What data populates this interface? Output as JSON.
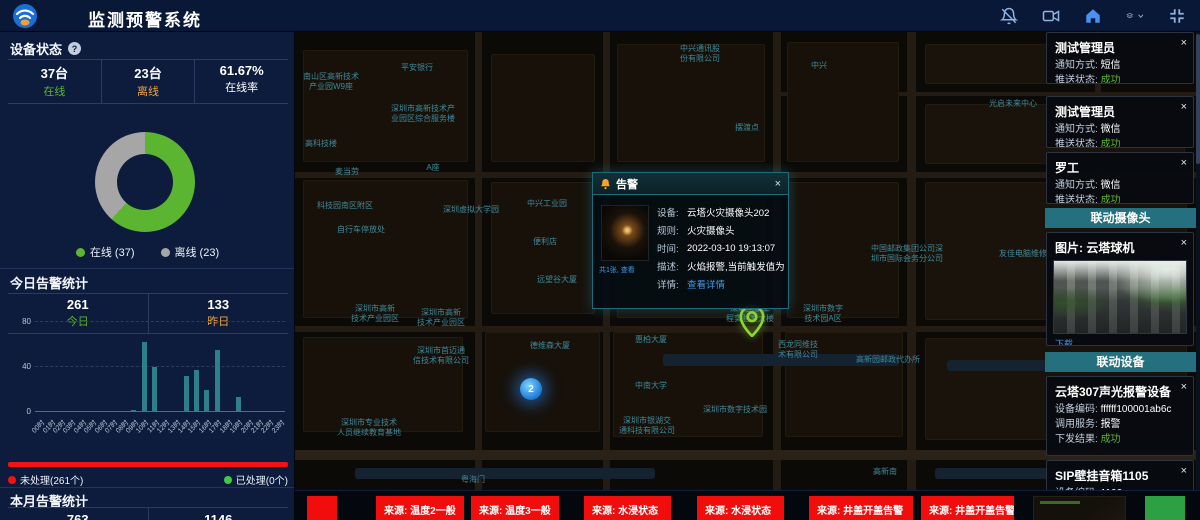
{
  "header": {
    "title": "监测预警系统",
    "icons": [
      "notification-bell-off",
      "video-camera",
      "home",
      "layer-switcher",
      "fullscreen-toggle"
    ]
  },
  "device_status": {
    "title": "设备状态",
    "help": "?",
    "stats": [
      {
        "value": "37台",
        "label": "在线"
      },
      {
        "value": "23台",
        "label": "离线"
      },
      {
        "value": "61.67%",
        "label": "在线率"
      }
    ],
    "legend": [
      {
        "label": "在线 (37)",
        "color": "#5cb531"
      },
      {
        "label": "离线 (23)",
        "color": "#a6a6a6"
      }
    ]
  },
  "today_alarms": {
    "title": "今日告警统计",
    "stats": [
      {
        "value": "261",
        "label": "今日"
      },
      {
        "value": "133",
        "label": "昨日"
      }
    ],
    "unprocessed": "未处理(261个)",
    "processed": "已处理(0个)"
  },
  "month_alarms": {
    "title": "本月告警统计",
    "values": [
      "763",
      "1146"
    ]
  },
  "chart_data": [
    {
      "id": "device-status-donut",
      "type": "pie",
      "labels": [
        "在线",
        "离线"
      ],
      "values": [
        37,
        23
      ],
      "colors": [
        "#5cb531",
        "#a6a6a6"
      ],
      "donut": true,
      "center_text": "",
      "legend_position": "bottom"
    },
    {
      "id": "today-alarms-by-hour",
      "type": "bar",
      "categories": [
        "00时",
        "01时",
        "02时",
        "03时",
        "04时",
        "05时",
        "06时",
        "07时",
        "08时",
        "09时",
        "10时",
        "11时",
        "12时",
        "13时",
        "14时",
        "15时",
        "16时",
        "17时",
        "18时",
        "19时",
        "20时",
        "21时",
        "22时",
        "23时"
      ],
      "values": [
        0,
        0,
        0,
        0,
        0,
        0,
        0,
        0,
        0,
        2,
        62,
        40,
        0,
        0,
        32,
        37,
        20,
        55,
        0,
        13,
        0,
        0,
        0,
        0
      ],
      "ylim": [
        0,
        80
      ],
      "yticks": [
        0,
        40,
        80
      ],
      "bar_color": "#2e7f8c",
      "grid": "dashed",
      "xlabel": "",
      "ylabel": ""
    }
  ],
  "map": {
    "labels": [
      {
        "text": "中兴通讯股\n份有限公司",
        "x": 405,
        "y": 22
      },
      {
        "text": "平安银行",
        "x": 122,
        "y": 36
      },
      {
        "text": "南山区高新技术\n产业园W9座",
        "x": 36,
        "y": 50
      },
      {
        "text": "深圳市高新技术产\n业园区综合服务楼",
        "x": 128,
        "y": 82
      },
      {
        "text": "高科技楼",
        "x": 26,
        "y": 112
      },
      {
        "text": "中兴",
        "x": 524,
        "y": 34
      },
      {
        "text": "光启未来中心",
        "x": 718,
        "y": 72
      },
      {
        "text": "麦当劳",
        "x": 52,
        "y": 140
      },
      {
        "text": "A座",
        "x": 138,
        "y": 136
      },
      {
        "text": "科技园南区附区",
        "x": 50,
        "y": 174
      },
      {
        "text": "深圳虚拟大学园",
        "x": 176,
        "y": 178
      },
      {
        "text": "中兴工业园",
        "x": 252,
        "y": 172
      },
      {
        "text": "便利店",
        "x": 250,
        "y": 210
      },
      {
        "text": "自行车停放处",
        "x": 66,
        "y": 198
      },
      {
        "text": "摆渡点",
        "x": 452,
        "y": 96
      },
      {
        "text": "中国邮政集团公司深\n圳市国际会务分公司",
        "x": 612,
        "y": 222
      },
      {
        "text": "友佳电脑维修",
        "x": 728,
        "y": 222
      },
      {
        "text": "远望谷大厦",
        "x": 262,
        "y": 248
      },
      {
        "text": "德维森大厦",
        "x": 255,
        "y": 314
      },
      {
        "text": "惠柏大厦",
        "x": 356,
        "y": 308
      },
      {
        "text": "深圳市高新\n技术产业园区",
        "x": 80,
        "y": 282
      },
      {
        "text": "深圳市高新\n技术产业园区",
        "x": 146,
        "y": 286
      },
      {
        "text": "深圳市首迈通\n信技术有限公司",
        "x": 146,
        "y": 324
      },
      {
        "text": "深圳市专业技术\n人员继续教育基地",
        "x": 74,
        "y": 396
      },
      {
        "text": "中南大学",
        "x": 356,
        "y": 354
      },
      {
        "text": "深圳市银湖交\n通科技有限公司",
        "x": 352,
        "y": 394
      },
      {
        "text": "深圳国家工\n程实验室大楼",
        "x": 455,
        "y": 282
      },
      {
        "text": "深圳市数字\n技术园A区",
        "x": 528,
        "y": 282
      },
      {
        "text": "西龙同维技\n术有限公司",
        "x": 503,
        "y": 318
      },
      {
        "text": "高新园邮政代办所",
        "x": 593,
        "y": 328
      },
      {
        "text": "深圳市数字技术园",
        "x": 440,
        "y": 378
      },
      {
        "text": "高新南",
        "x": 590,
        "y": 440
      },
      {
        "text": "粤海门",
        "x": 178,
        "y": 448
      }
    ],
    "markers": [
      {
        "type": "cluster",
        "value": "2",
        "x": 236,
        "y": 357
      },
      {
        "type": "pin",
        "x": 457,
        "y": 303
      }
    ]
  },
  "popup": {
    "title": "告警",
    "close": "×",
    "photo_caption": "共1张, 查看",
    "rows": [
      {
        "label": "设备:",
        "value": "云塔火灾摄像头202"
      },
      {
        "label": "规则:",
        "value": "火灾摄像头"
      },
      {
        "label": "时间:",
        "value": "2022-03-10 19:13:07"
      },
      {
        "label": "描述:",
        "value": "火焰报警,当前触发值为..."
      },
      {
        "label": "详情:",
        "value": "查看详情"
      }
    ]
  },
  "notifications": [
    {
      "name": "测试管理员",
      "method_label": "通知方式:",
      "method": "短信",
      "status_label": "推送状态:",
      "status": "成功",
      "close": "×"
    },
    {
      "name": "测试管理员",
      "method_label": "通知方式:",
      "method": "微信",
      "status_label": "推送状态:",
      "status": "成功",
      "close": "×"
    },
    {
      "name": "罗工",
      "method_label": "通知方式:",
      "method": "微信",
      "status_label": "推送状态:",
      "status": "成功",
      "close": "×"
    }
  ],
  "camera_section": {
    "title": "联动摄像头",
    "card_title": "图片: 云塔球机",
    "download_label": "下载",
    "close": "×"
  },
  "device_section": {
    "title": "联动设备",
    "cards": [
      {
        "name": "云塔307声光报警设备",
        "close": "×",
        "rows": [
          {
            "label": "设备编码:",
            "value": "ffffff100001ab6c"
          },
          {
            "label": "调用服务:",
            "value": "报警"
          },
          {
            "label": "下发结果:",
            "value": "成功"
          }
        ]
      },
      {
        "name": "SIP壁挂音箱1105",
        "close": "×",
        "rows": [
          {
            "label": "设备编码:",
            "value": "1106"
          }
        ]
      }
    ]
  },
  "bottom_alerts": [
    "来源: 温度2一般",
    "来源: 温度3一般",
    "来源: 水浸状态",
    "来源: 水浸状态",
    "来源: 井盖开盖告警",
    "来源: 井盖开盖告警"
  ]
}
